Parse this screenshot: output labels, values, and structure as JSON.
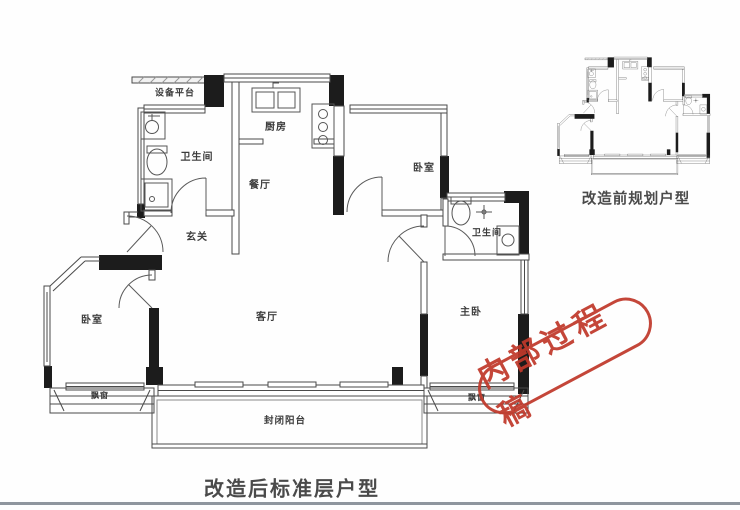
{
  "page": {
    "main_caption": "改造后标准层户型",
    "mini_caption": "改造前规划户型"
  },
  "stamp": {
    "text": "内部过程稿",
    "color": "#c0392b"
  },
  "main_plan": {
    "rooms": {
      "equipment_platform": "设备平台",
      "bathroom_left": "卫生间",
      "kitchen": "厨房",
      "dining": "餐厅",
      "bedroom_top": "卧室",
      "bathroom_right": "卫生间",
      "entry": "玄关",
      "bedroom_left": "卧室",
      "living": "客厅",
      "master_bedroom": "主卧",
      "bay_window_left": "飘窗",
      "bay_window_right": "飘窗",
      "balcony": "封闭阳台"
    }
  },
  "colors": {
    "stamp_red": "#c0392b",
    "wall_black": "#1c1c1c",
    "line_gray": "#4a4a4a",
    "divider_gray": "#8f969e"
  }
}
